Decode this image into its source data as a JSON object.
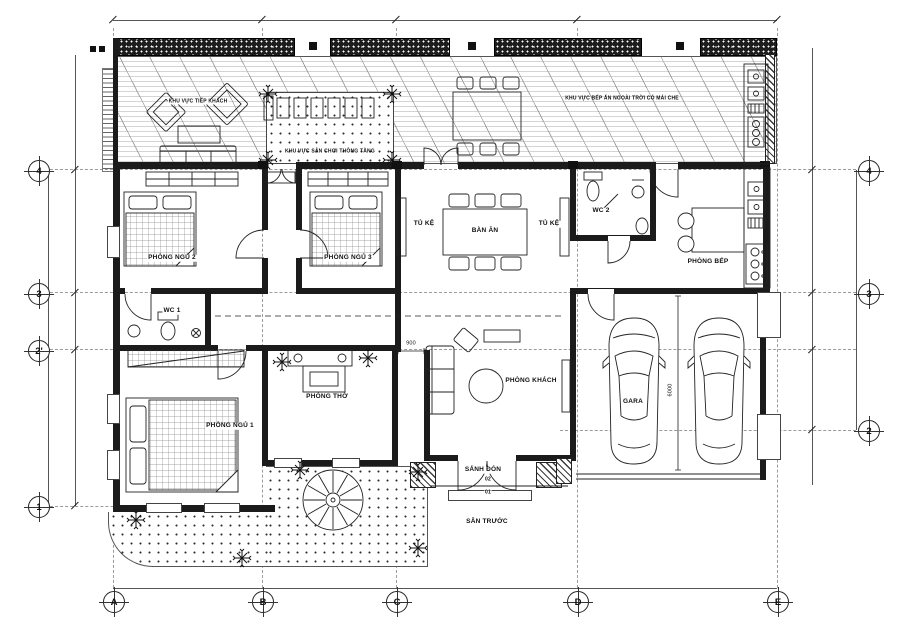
{
  "plan": {
    "rooms": {
      "bedroom1": "PHÒNG NGỦ 1",
      "bedroom2": "PHÒNG NGỦ 2",
      "bedroom3": "PHÒNG NGỦ 3",
      "wc1": "WC 1",
      "wc2": "WC 2",
      "kitchen": "PHÒNG BẾP",
      "worship": "PHÒNG THỜ",
      "living": "PHÒNG KHÁCH",
      "garage": "GARA",
      "dining": "BÀN ĂN",
      "shelf": "TỦ KỆ",
      "porch": "SẢNH ĐÓN",
      "front_yard": "SÂN TRƯỚC"
    },
    "outdoor": {
      "lounge": "KHU VỰC TIẾP KHÁCH",
      "play": "KHU VỰC SÂN CHƠI THÔNG TẦNG",
      "bbq": "KHU VỰC BẾP ĂN NGOÀI TRỜI CÓ MÁI CHE"
    },
    "dims": {
      "passage_width": "900",
      "garage_depth": "6000",
      "step_top": "02",
      "step_bottom": "01"
    },
    "grid": {
      "cols": [
        "A",
        "B",
        "C",
        "D",
        "E"
      ],
      "rows_left": [
        "4",
        "3",
        "2'",
        "1"
      ],
      "rows_right": [
        "4",
        "3",
        "2"
      ]
    },
    "colors": {
      "ink": "#1b1b1b",
      "paper": "#ffffff"
    }
  }
}
